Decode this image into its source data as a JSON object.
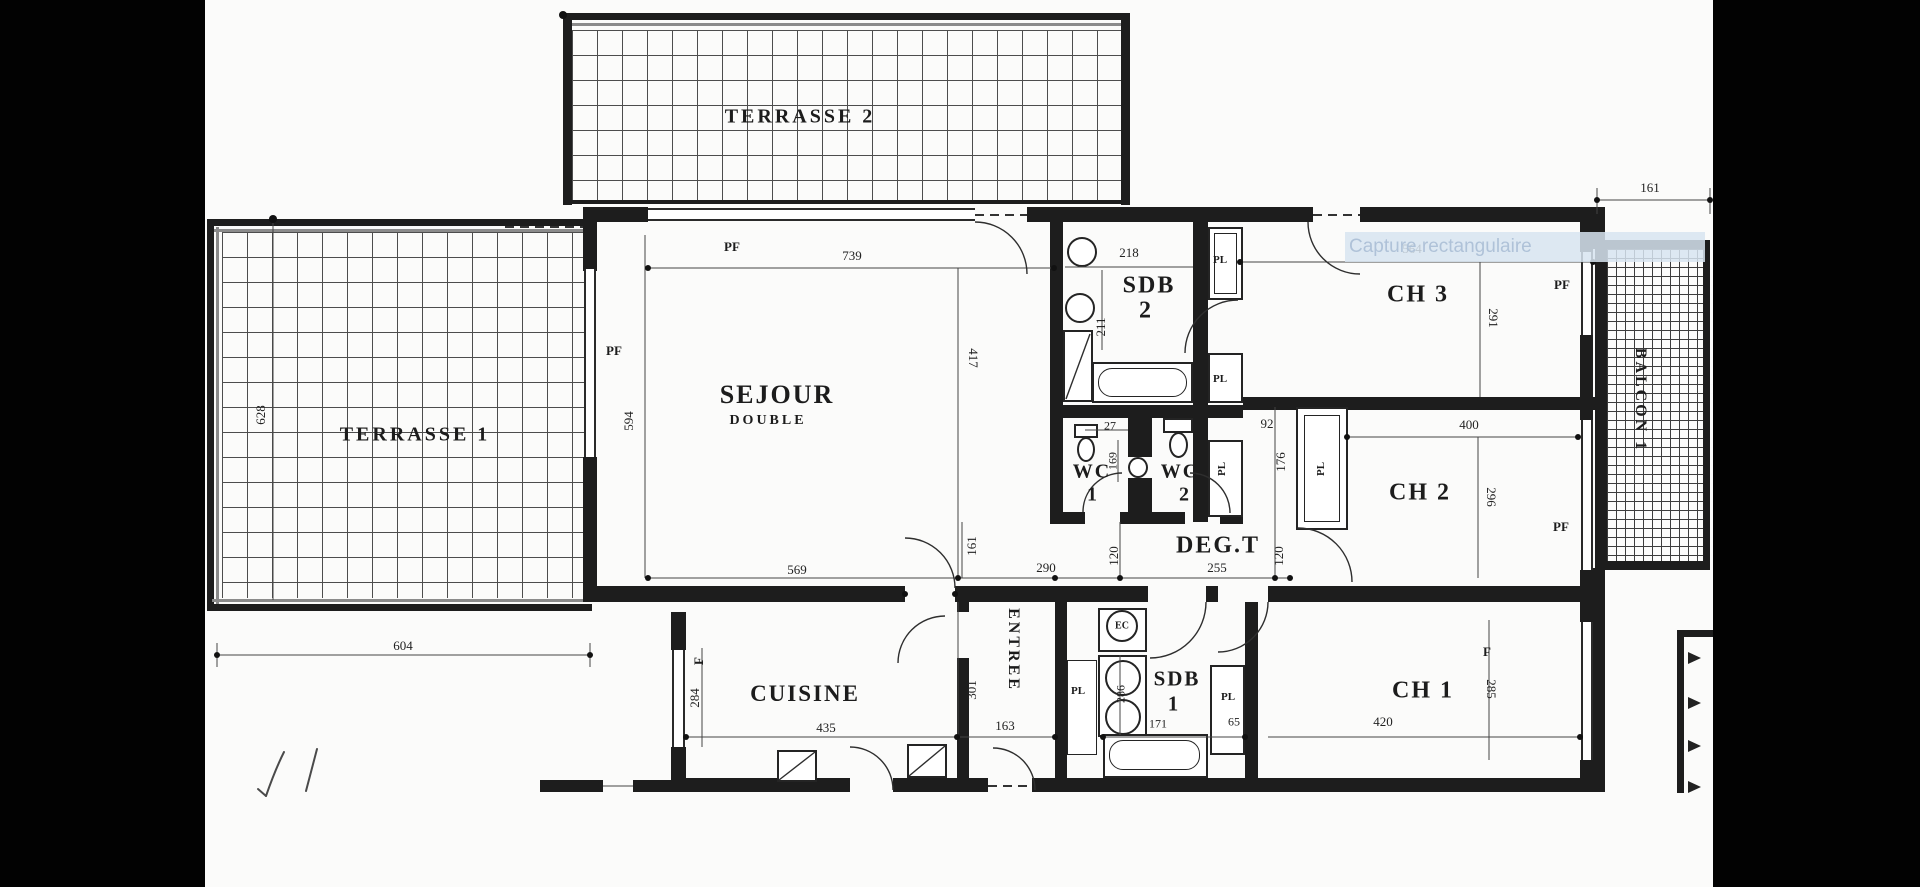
{
  "watermark": {
    "text": "Capture rectangulaire"
  },
  "rooms": {
    "terrasse2": {
      "label": "TERRASSE 2"
    },
    "terrasse1": {
      "label": "TERRASSE 1"
    },
    "sejour": {
      "label": "SEJOUR",
      "sublabel": "DOUBLE"
    },
    "sdb2": {
      "label": "SDB",
      "number": "2"
    },
    "ch3": {
      "label": "CH 3"
    },
    "balcon1": {
      "label": "BALCON 1"
    },
    "wc1": {
      "label": "WC",
      "number": "1"
    },
    "wc2": {
      "label": "WC",
      "number": "2"
    },
    "degt": {
      "label": "DEG.T"
    },
    "ch2": {
      "label": "CH 2"
    },
    "entree": {
      "label": "ENTREE"
    },
    "cuisine": {
      "label": "CUISINE"
    },
    "sdb1": {
      "label": "SDB",
      "number": "1"
    },
    "ch1": {
      "label": "CH 1"
    }
  },
  "openings": {
    "pf": "PF",
    "pl": "PL",
    "f": "F",
    "ec": "EC"
  },
  "dimensions": {
    "sejour_top": "739",
    "sejour_left": "594",
    "sejour_right": "417",
    "terrasse1_height": "628",
    "terrasse1_width": "604",
    "sejour_bottom": "569",
    "hall_width": "290",
    "hall_door": "161",
    "degt_width": "255",
    "degt_left": "120",
    "degt_right": "120",
    "sdb2_width": "218",
    "sdb2_height": "211",
    "wc1_nib": "27",
    "wc1_width": "169",
    "ch2_nib": "92",
    "ch2_closet": "176",
    "ch3_width": "564",
    "ch3_height": "291",
    "balcon_width": "161",
    "ch2_width": "400",
    "ch2_height": "296",
    "cuisine_width": "435",
    "cuisine_window": "284",
    "entree_height": "301",
    "entree_width": "163",
    "sdb1_left": "286",
    "sdb1_width": "171",
    "sdb1_closet": "65",
    "ch1_width": "420",
    "ch1_window": "285"
  },
  "colors": {
    "wall": "#1d1d1d",
    "paper": "#fbfbfa",
    "letterbox": "#020202",
    "watermark_bg": "#d7e4f0",
    "watermark_text": "#afc2d8"
  }
}
